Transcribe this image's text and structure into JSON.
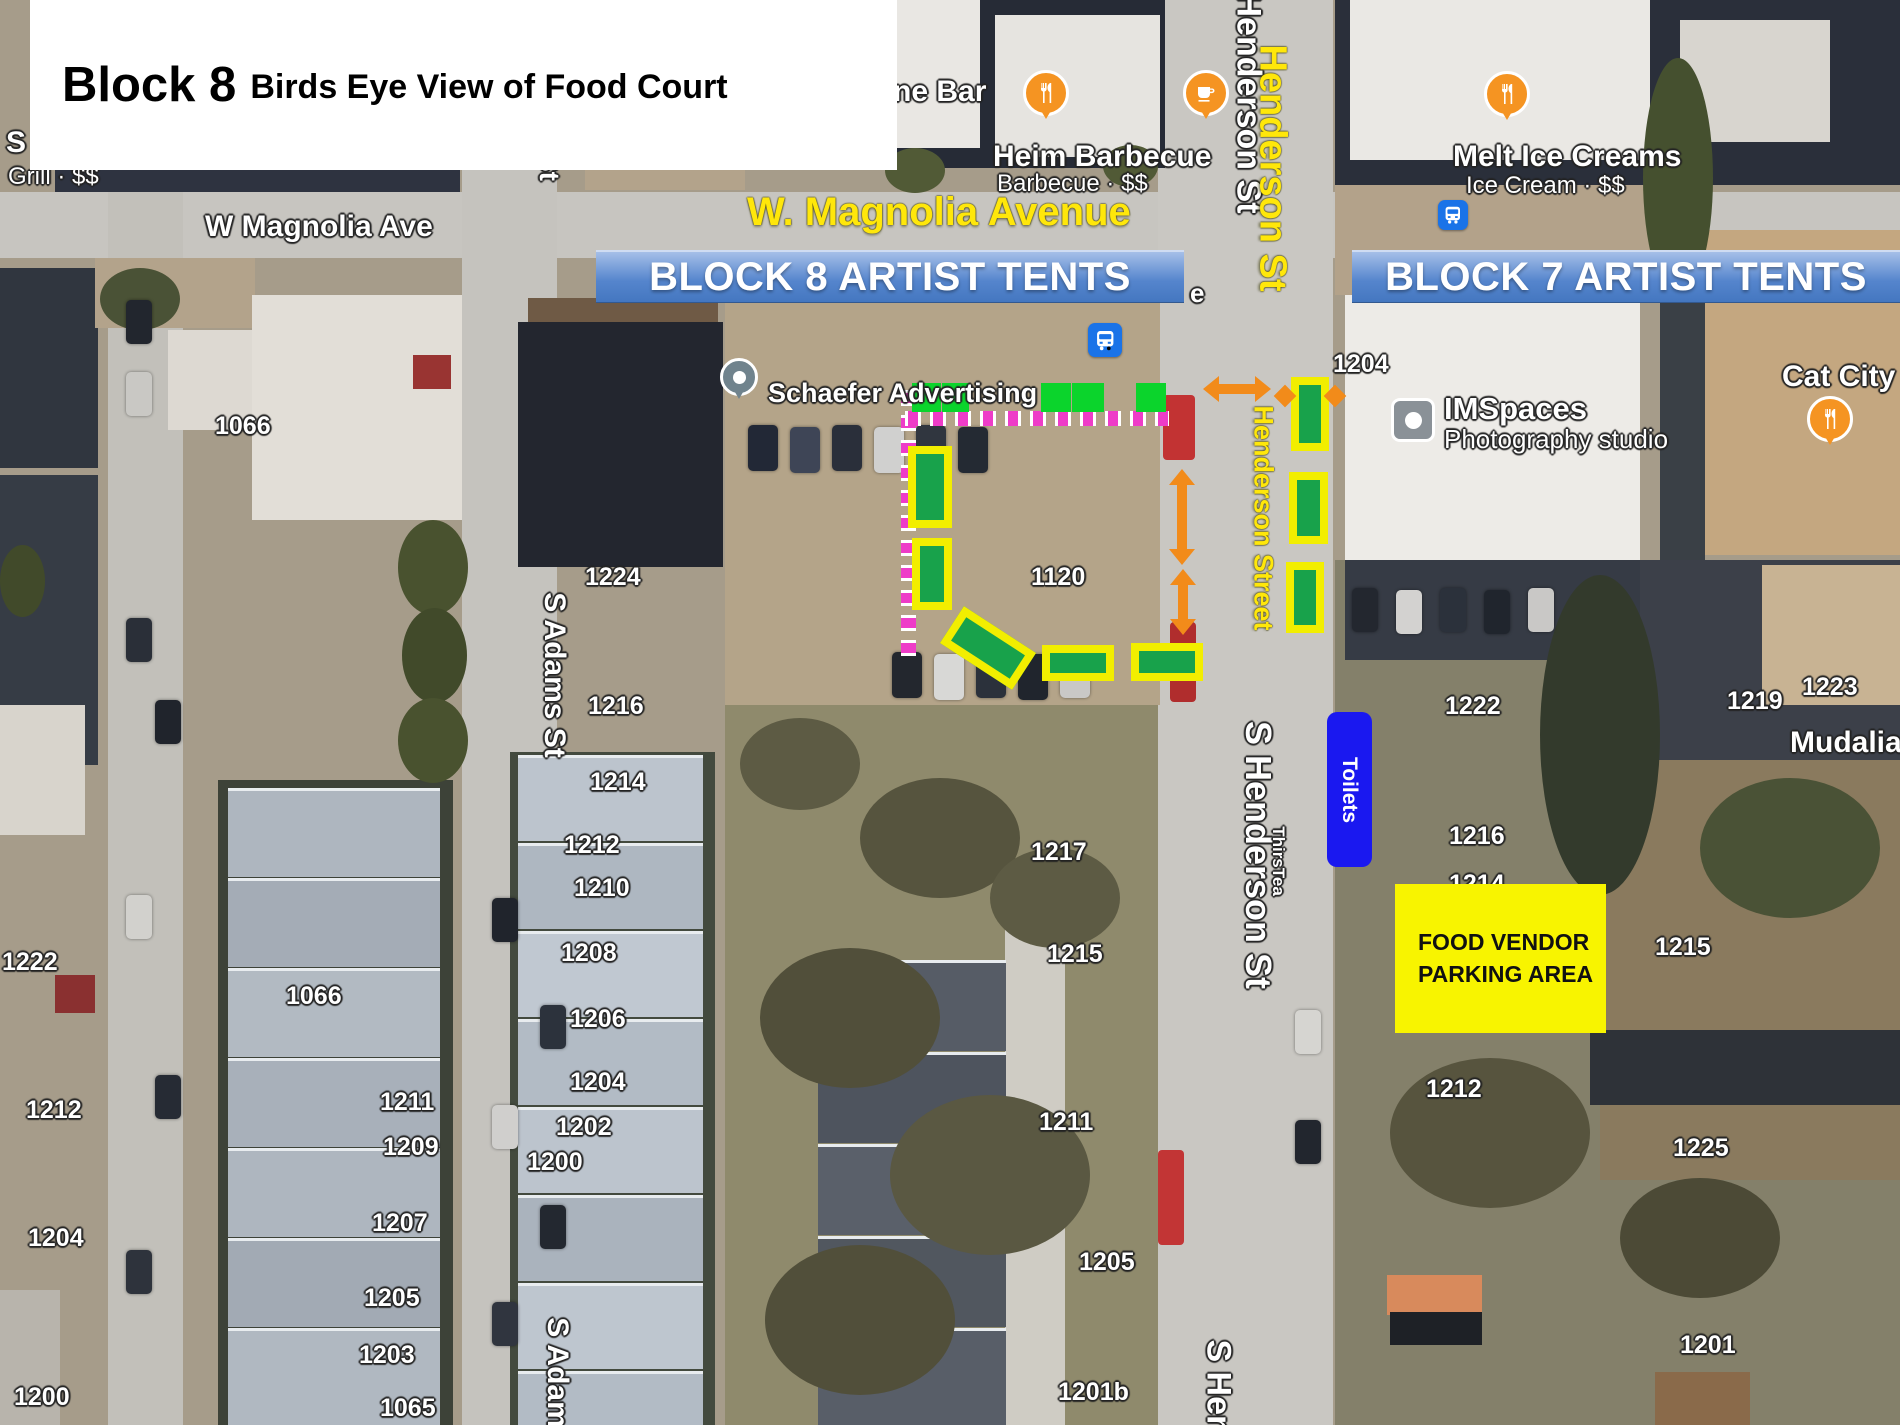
{
  "title": {
    "main": "Block 8",
    "subtitle": "Birds Eye View of Food Court"
  },
  "banners": {
    "block8": "BLOCK 8 ARTIST TENTS",
    "block7": "BLOCK 7 ARTIST TENTS"
  },
  "annotations": {
    "magnolia_avenue": "W. Magnolia Avenue",
    "henderson_st": "Henderson St",
    "henderson_street": "Henderson Street",
    "toilets": "Toilets",
    "food_vendor_line1": "FOOD VENDOR",
    "food_vendor_line2": "PARKING AREA"
  },
  "map": {
    "streets": {
      "w_magnolia_ave": "W Magnolia Ave",
      "adams_st_top": "St",
      "s_adams_st": "S Adams St",
      "s_adams_st_bottom": "S Adams St",
      "henderson_st_top": "Henderson St",
      "s_henderson_st": "S Henderson St",
      "s_henderson_st_bottom": "S Hend",
      "ave_fragment": "e"
    },
    "pois": {
      "bar_partial": "ne Bar",
      "grill_name_partial": "S",
      "grill_sub": "Grill · $$",
      "heim_name": "Heim Barbecue",
      "heim_sub": "Barbecue · $$",
      "melt_name": "Melt Ice Creams",
      "melt_sub": "Ice Cream · $$",
      "schaefer": "Schaefer Advertising",
      "imspaces_name": "IMSpaces",
      "imspaces_sub": "Photography studio",
      "cat_city_partial": "Cat City G",
      "mudaliar_partial": "Mudalia",
      "thirstea": "ThirsTea"
    },
    "addresses": [
      "1066",
      "1224",
      "1216",
      "1066",
      "1222",
      "1212",
      "1204",
      "1200",
      "1211",
      "1209",
      "1207",
      "1205",
      "1203",
      "1065",
      "1214",
      "1212",
      "1210",
      "1208",
      "1206",
      "1204",
      "1202",
      "1200",
      "1120",
      "1217",
      "1215",
      "1211",
      "1205",
      "1201b",
      "1204",
      "1222",
      "1216",
      "1214",
      "1219",
      "1215",
      "1212",
      "1225",
      "1201",
      "1223"
    ]
  },
  "colors": {
    "tent_green": "#18A24B",
    "tent_border_yellow": "#F2EE00",
    "marker_green": "#0BD42C",
    "route_magenta": "#EE3CC8",
    "arrow_orange": "#F28B1A",
    "banner_blue": "#5585CD",
    "toilets_blue": "#1A18F0",
    "vendor_yellow": "#F8F400",
    "street_label_yellow": "#FFE70A"
  }
}
